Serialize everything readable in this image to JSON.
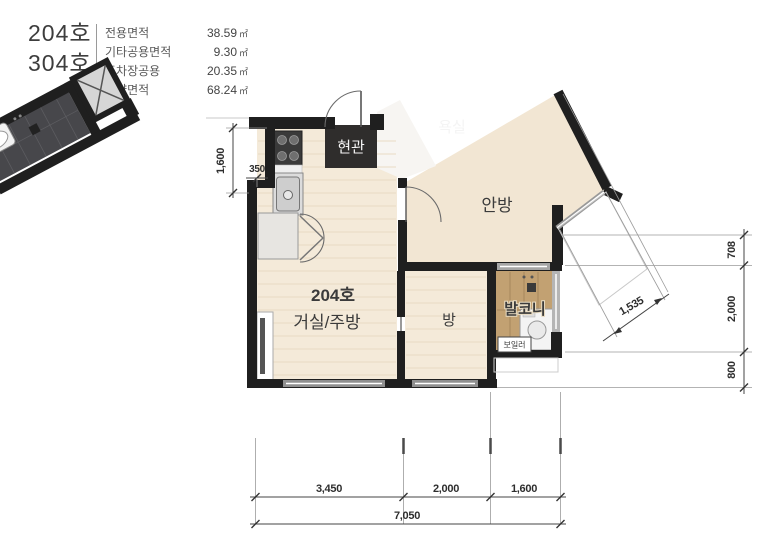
{
  "header": {
    "unit_numbers": [
      "204호",
      "304호"
    ],
    "area_table": {
      "rows": [
        {
          "label": "전용면적",
          "value": "38.59",
          "unit": "㎡"
        },
        {
          "label": "기타공용면적",
          "value": "9.30",
          "unit": "㎡"
        },
        {
          "label": "주차장공용",
          "value": "20.35",
          "unit": "㎡"
        },
        {
          "label": "계약면적",
          "value": "68.24",
          "unit": "㎡"
        }
      ]
    }
  },
  "floor_plan": {
    "rooms": {
      "entrance": "현관",
      "bathroom": "욕실",
      "master_bedroom": "안방",
      "unit_label": "204호",
      "living_kitchen": "거실/주방",
      "room": "방",
      "balcony": "발코니",
      "boiler": "보일러"
    },
    "dimensions": {
      "left_height": "1,600",
      "wall_offset": "350",
      "right": [
        "708",
        "2,000",
        "800"
      ],
      "diagonal": "1,535",
      "bottom_segments": [
        "3,450",
        "2,000",
        "1,600"
      ],
      "bottom_total": "7,050"
    },
    "colors": {
      "wall": "#1f1f1f",
      "wood_floor": "#f4ead9",
      "balcony_wood": "#c2a172",
      "bathroom_tile": "#47474b",
      "entrance_dark": "#2f2d2c",
      "dimension_text": "#2e2e2e"
    }
  }
}
